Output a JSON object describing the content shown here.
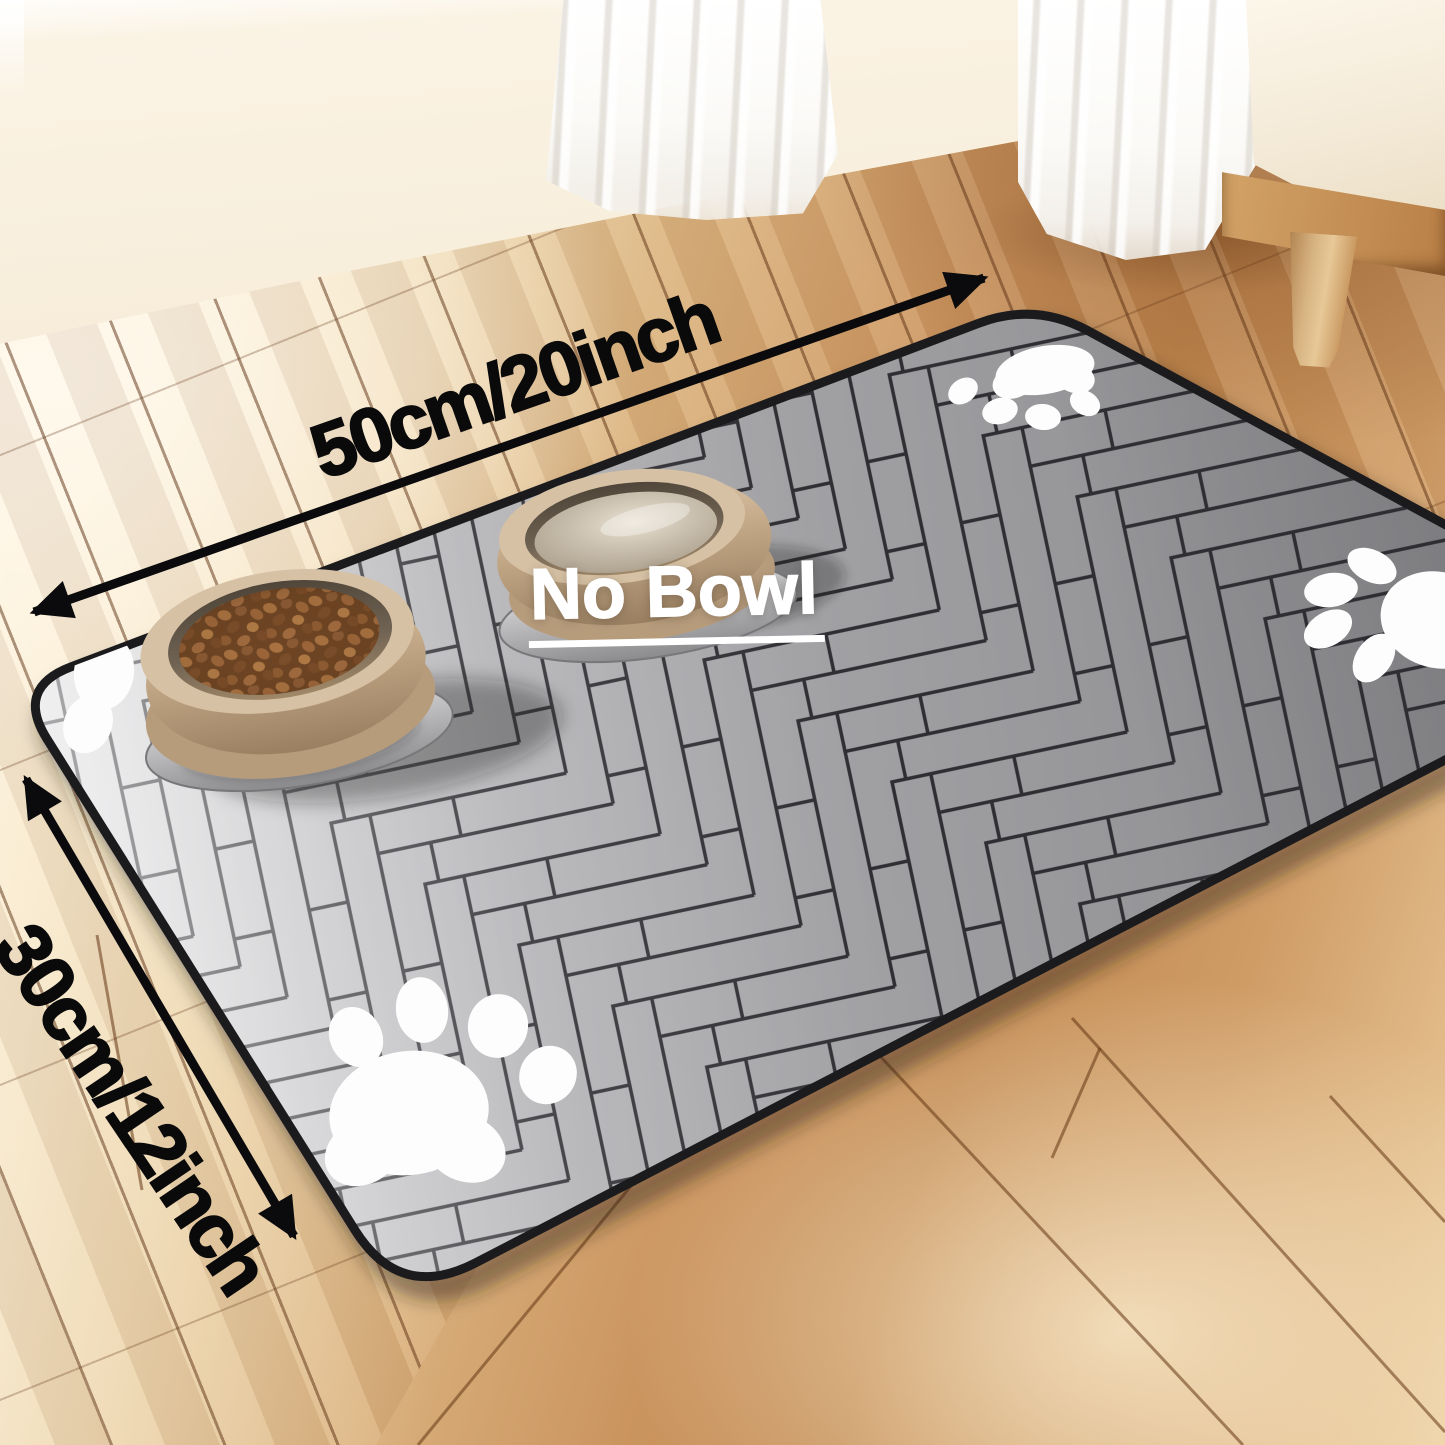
{
  "scene": {
    "labels": {
      "width": "50cm/20inch",
      "height": "30cm/12inch",
      "no_bowl": "No Bowl"
    },
    "colors": {
      "arrow_black": "#0b0b0d",
      "label_black": "#0a0a0a",
      "no_bowl_white": "#ffffff",
      "mat_gray": "#9d9da0",
      "mat_gray_light": "#d8d8da",
      "mat_gray_dark": "#87878a",
      "mat_line": "#2e2e33",
      "mat_edge": "#1b1b1e",
      "paw_white": "#fdfdfd",
      "floor_light": "#f6e8c9",
      "floor_mid": "#cb9560",
      "floor_dark": "#b5793f",
      "floor_seam": "#5c3012",
      "wall_cream": "#f2e3cb",
      "curtain_white": "#fbfaf7",
      "cabinet_cream": "#f3e9d6",
      "wood_leg": "#d7b382",
      "bowl_tan": "#c3a887",
      "bowl_rim": "#d6c1a4",
      "kibble_brown": "#8a5a34",
      "water_beige": "#c9bfae",
      "plate_silver": "#b4b4b6"
    },
    "objects": {
      "mat_pattern": "herringbone",
      "paw_print_count": 4,
      "bowl_count": 2
    }
  }
}
